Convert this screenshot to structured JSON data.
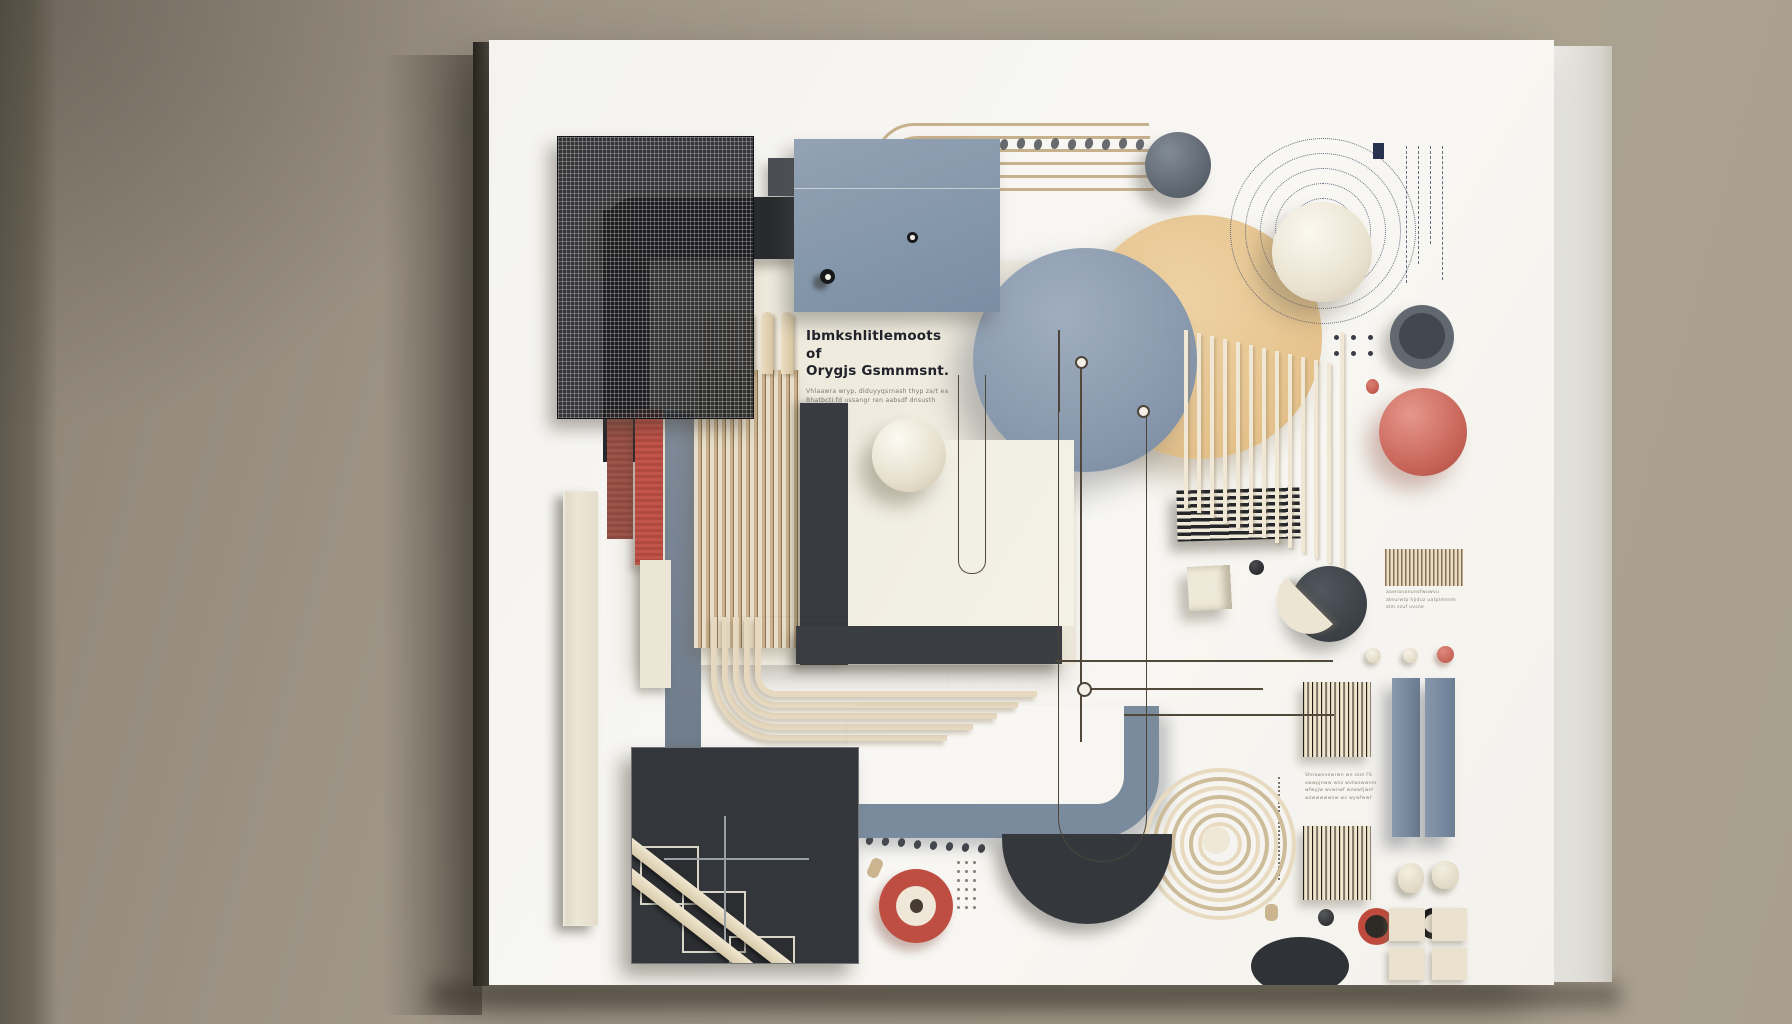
{
  "scene": {
    "title": "Abstract 3D geometric relief artwork on a white canvas panel, mounted on a taupe wall",
    "wall_color": "#a29988",
    "canvas_color": "#f6f5f1",
    "palette": {
      "slate_blue": "#8b9aac",
      "tan": "#e7c591",
      "charcoal": "#35383d",
      "cream": "#ece6d6",
      "red": "#c05348",
      "coral": "#cd6b5f",
      "maroon": "#8e4a41",
      "wire_brown": "#51483a"
    }
  },
  "text_panel": {
    "heading_line1": "Ibmkshlitlemoots of",
    "heading_line2": "Orygjs Gsmnmsnt.",
    "body_line1": "Vhlaawra wryp, dlduyyqsrnash thyp za/t ea",
    "body_line2": "Bhatbcti fd ussangr ren aabsdf dnsusth"
  },
  "side_texts": {
    "right_small": [
      "aaenananunofwuwvu",
      "ateurwtp hjiduz uatplmnnm",
      "alm szuf uvsne"
    ],
    "mid_right": [
      "Shnawevewrwn wn szst FS",
      "awwpjnww wnz wvtwzwwnm",
      "wfwyjw wvwnwf wzwwfjwsf",
      "wzwwwwwnw wv wywfwwf"
    ]
  }
}
